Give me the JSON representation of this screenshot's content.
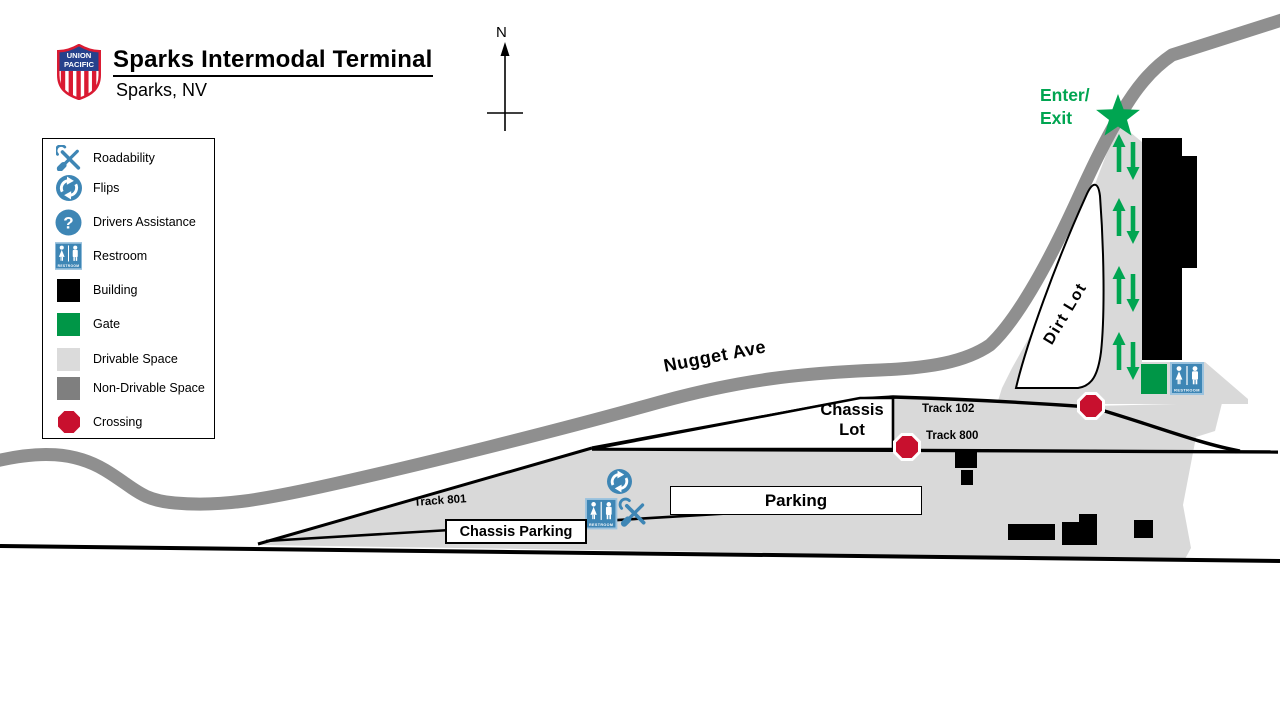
{
  "header": {
    "title": "Sparks Intermodal Terminal",
    "subtitle": "Sparks, NV",
    "logo_line1": "UNION",
    "logo_line2": "PACIFIC"
  },
  "compass": {
    "north_label": "N"
  },
  "legend": {
    "items": [
      {
        "label": "Roadability"
      },
      {
        "label": "Flips"
      },
      {
        "label": "Drivers Assistance"
      },
      {
        "label": "Restroom"
      },
      {
        "label": "Building"
      },
      {
        "label": "Gate"
      },
      {
        "label": "Drivable Space"
      },
      {
        "label": "Non-Drivable Space"
      },
      {
        "label": "Crossing"
      }
    ]
  },
  "icons": {
    "restroom_text": "RESTROOM",
    "question_glyph": "?"
  },
  "map": {
    "street_label": "Nugget Ave",
    "entrance_line1": "Enter/",
    "entrance_line2": "Exit",
    "dirt_lot_label": "Dirt Lot",
    "chassis_lot_line1": "Chassis",
    "chassis_lot_line2": "Lot",
    "parking_label": "Parking",
    "chassis_parking_label": "Chassis Parking",
    "track_102_label": "Track 102",
    "track_800_label": "Track 800",
    "track_801_label": "Track 801"
  },
  "colors": {
    "drivable_space": "#d9d9d9",
    "non_drivable_space": "#7f7f7f",
    "road_gray": "#8f8f8f",
    "gate_green": "#009647",
    "accent_green": "#00a551",
    "crossing_red": "#c8102e",
    "icon_blue": "#3e86b5",
    "building": "#000000"
  }
}
